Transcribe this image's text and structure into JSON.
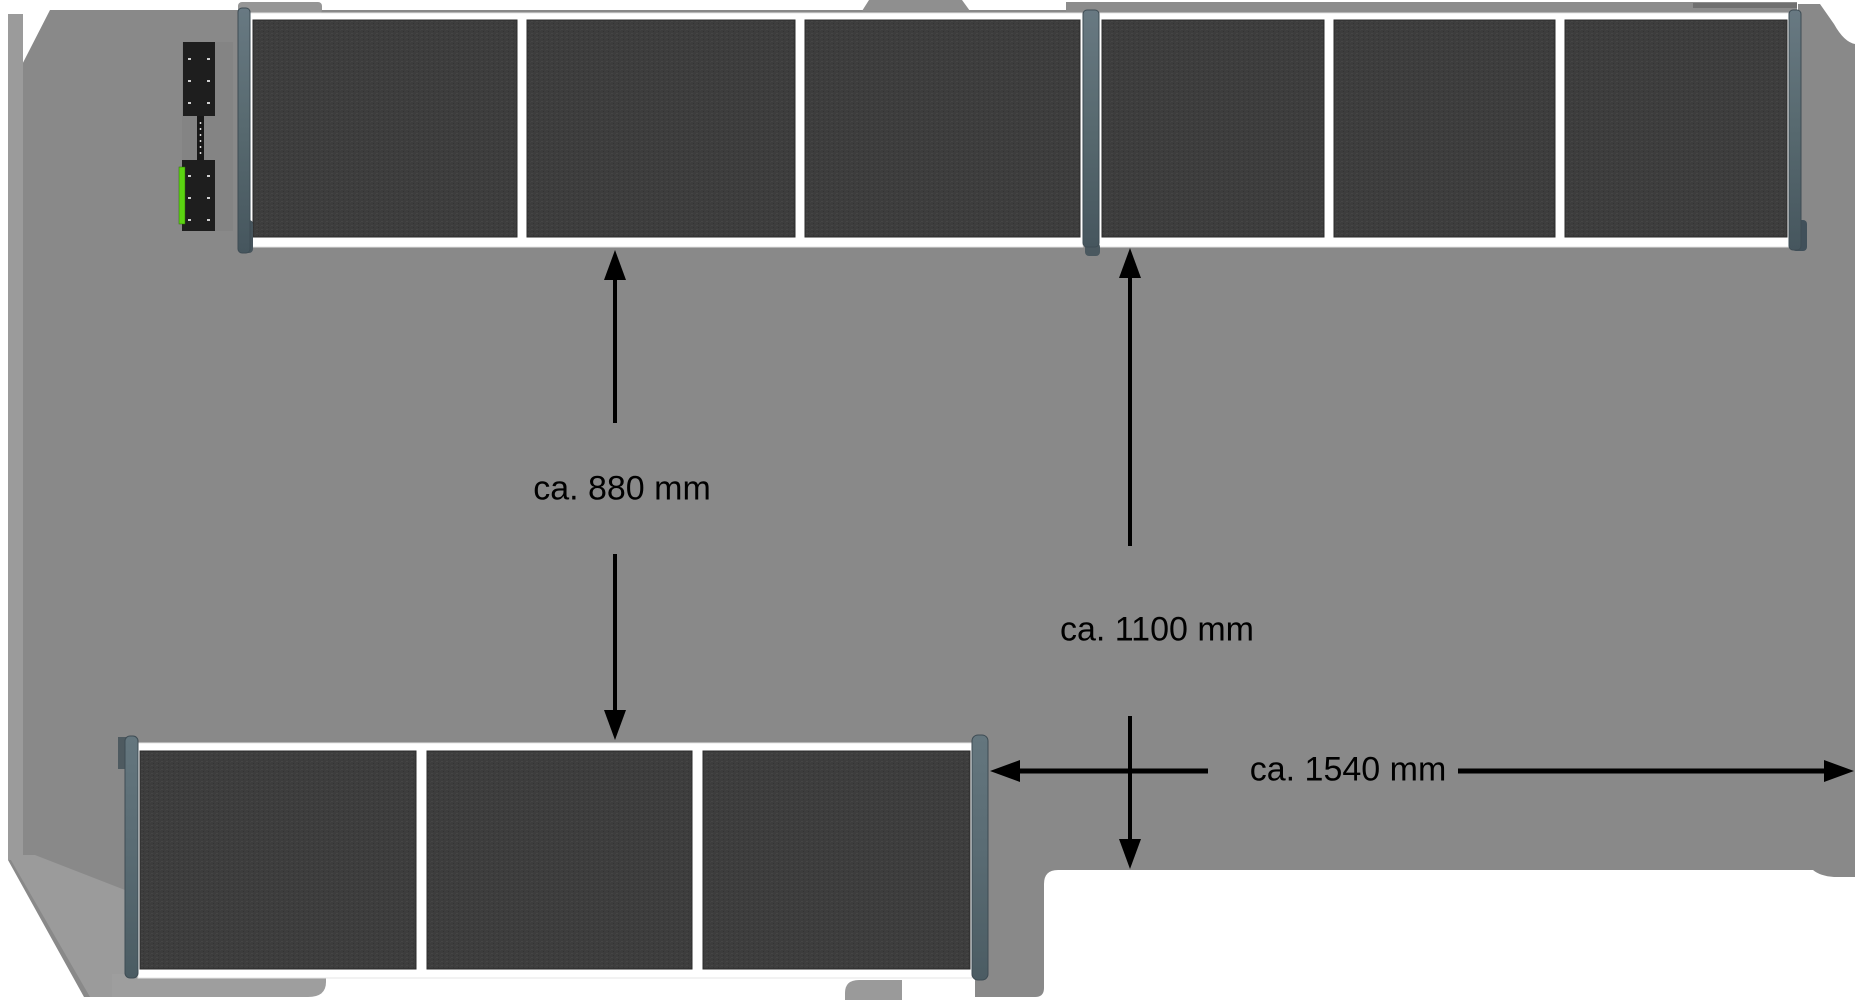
{
  "diagram": {
    "description": "Top view technical illustration of a vehicle roof with two rows of dark framed panels and distance dimension arrows",
    "annotations": [
      {
        "id": "dim-880",
        "label": "ca. 880 mm",
        "orientation": "vertical",
        "meaning": "distance between front panel row and rear panel row"
      },
      {
        "id": "dim-1100",
        "label": "ca. 1100 mm",
        "orientation": "vertical",
        "meaning": "distance between front panel row and roof cutout edge"
      },
      {
        "id": "dim-1540",
        "label": "ca. 1540 mm",
        "orientation": "horizontal",
        "meaning": "distance between rear panel row end post and right roof edge"
      }
    ],
    "panel_rows": {
      "front_row_panel_count": 6,
      "front_row_sections": 2,
      "rear_row_panel_count": 3
    },
    "colors": {
      "roof_gray": "#898989",
      "roof_light_gray": "#9c9c9c",
      "roof_dark_strip": "#707070",
      "panel_dark": "#3d3d3d",
      "frame_white": "#ffffff",
      "post_blue_gray": "#5d6e79",
      "post_dark": "#44525b",
      "bracket_black": "#1e1e1e",
      "bracket_green": "#5bd411",
      "dimension_black": "#000000"
    }
  }
}
